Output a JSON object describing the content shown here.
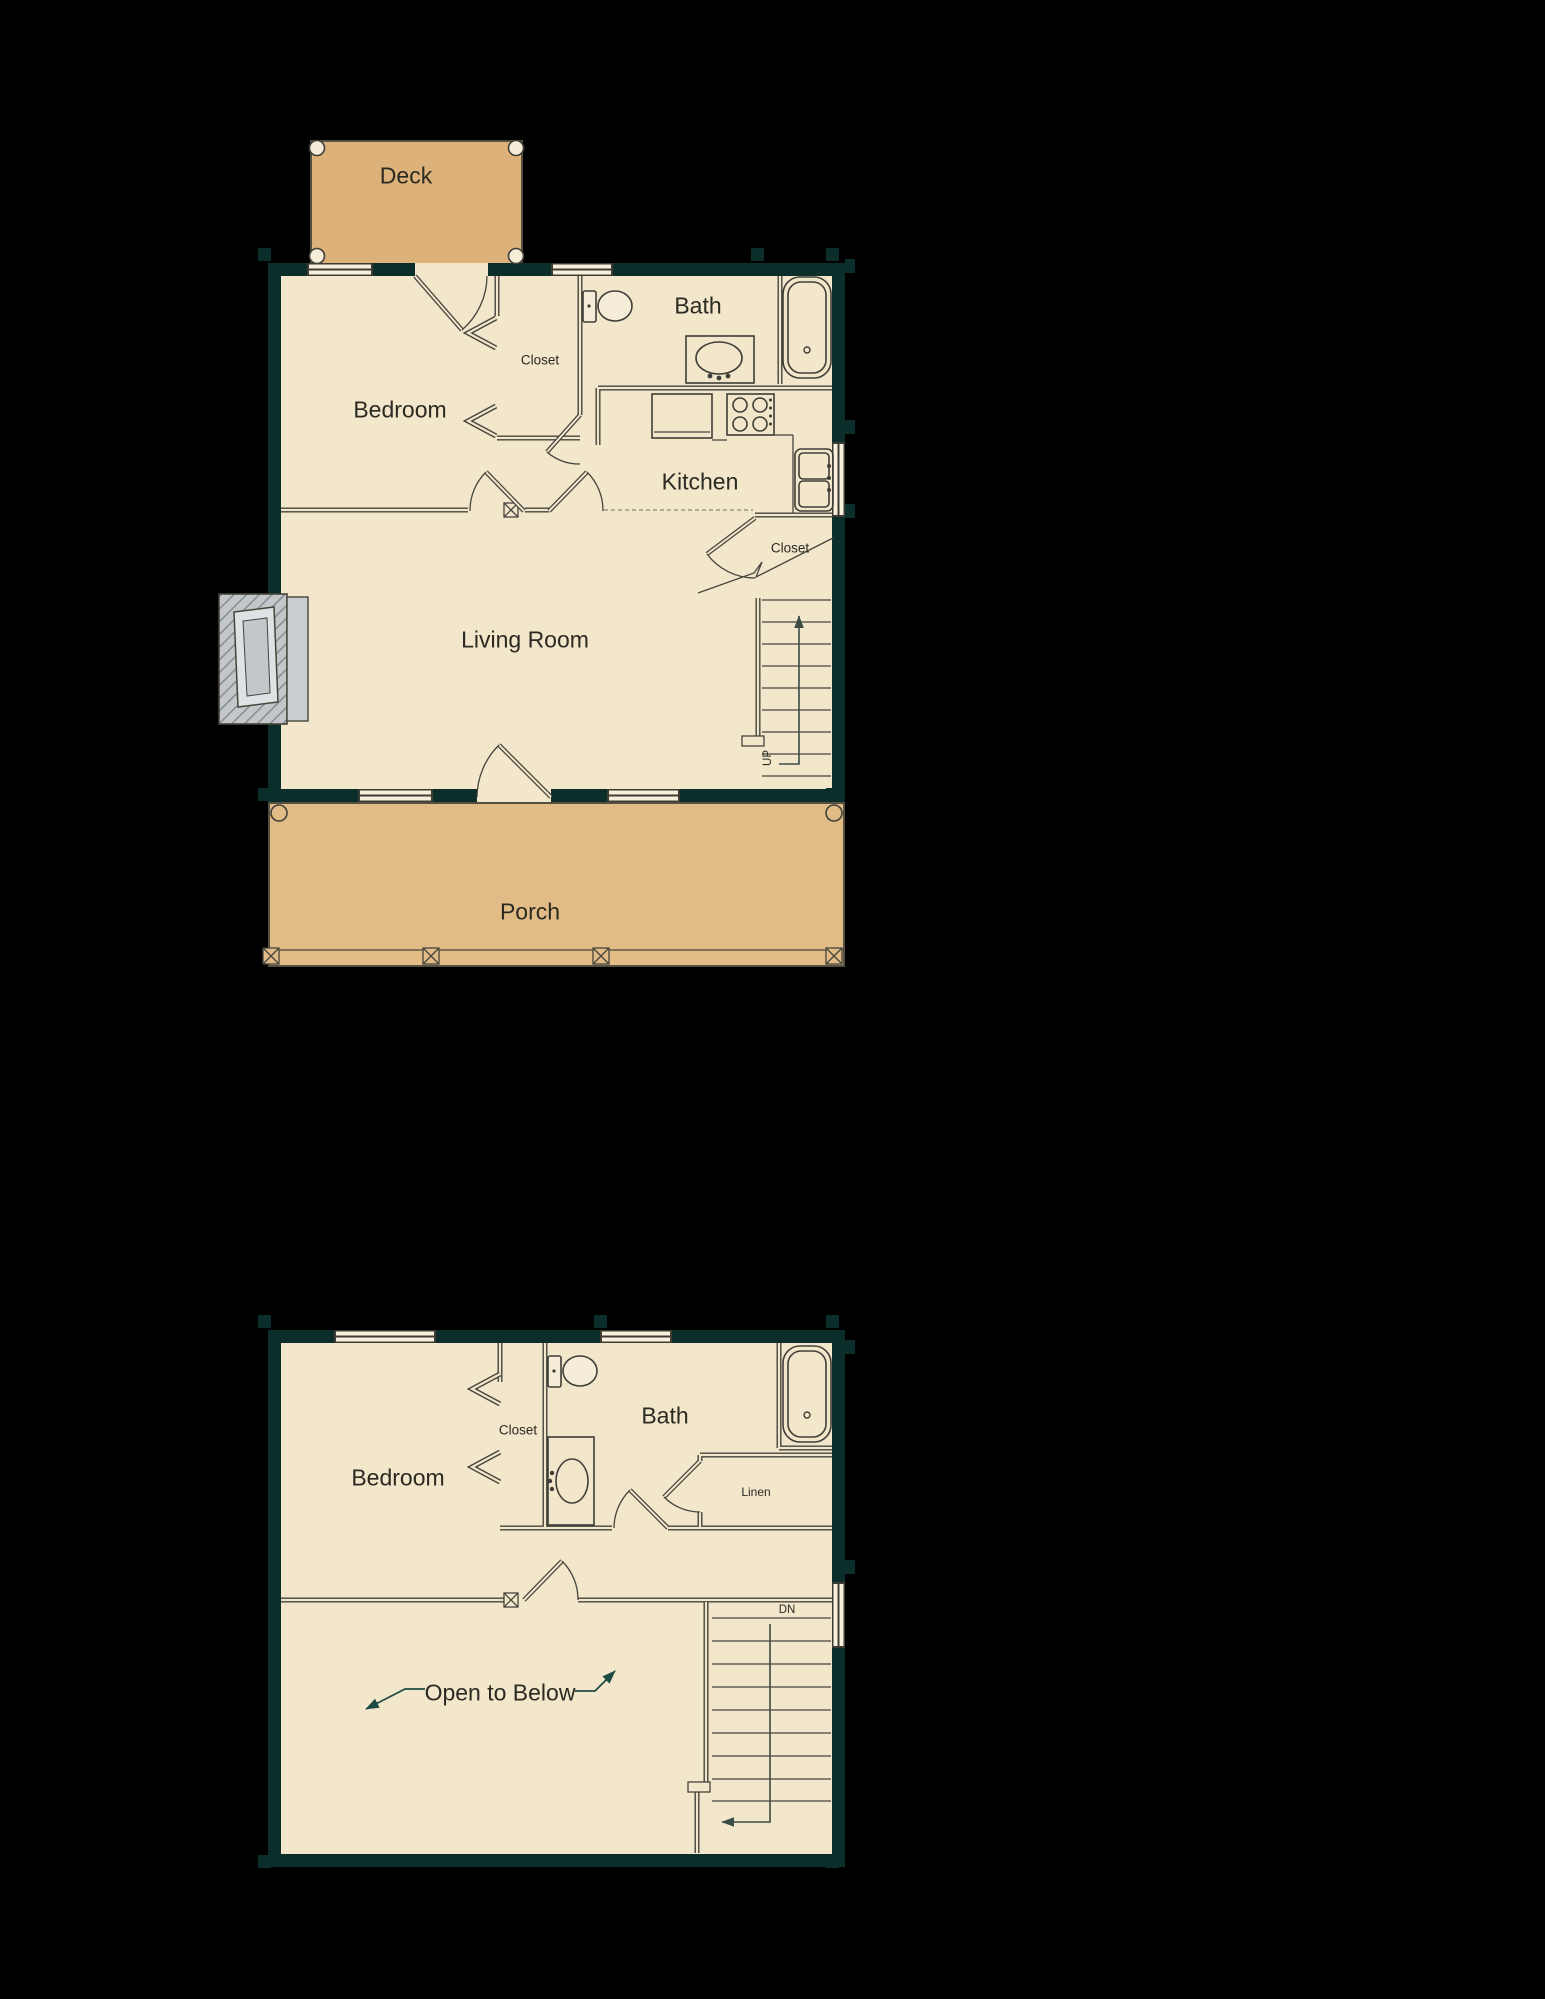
{
  "document": {
    "type": "log-home-floor-plan",
    "floors_shown": 2
  },
  "palette": {
    "background": "#000000",
    "wall_teal": "#0c2e2a",
    "interior_cream": "#f2e6cb",
    "deck_tan": "#ddb17a",
    "porch_tan": "#e2bc87",
    "fireplace_gray": "#c3c7ca",
    "line_dark": "#45453c",
    "arrow_teal": "#1d4a43"
  },
  "floor1": {
    "labels": {
      "deck": "Deck",
      "bedroom": "Bedroom",
      "closet_bedroom": "Closet",
      "bath": "Bath",
      "kitchen": "Kitchen",
      "living_room": "Living Room",
      "closet_stairs": "Closet",
      "stairs_direction": "UP",
      "porch": "Porch"
    }
  },
  "floor2": {
    "labels": {
      "bedroom": "Bedroom",
      "closet": "Closet",
      "bath": "Bath",
      "linen": "Linen",
      "stairs_direction": "DN",
      "open_to_below": "Open to Below"
    }
  }
}
